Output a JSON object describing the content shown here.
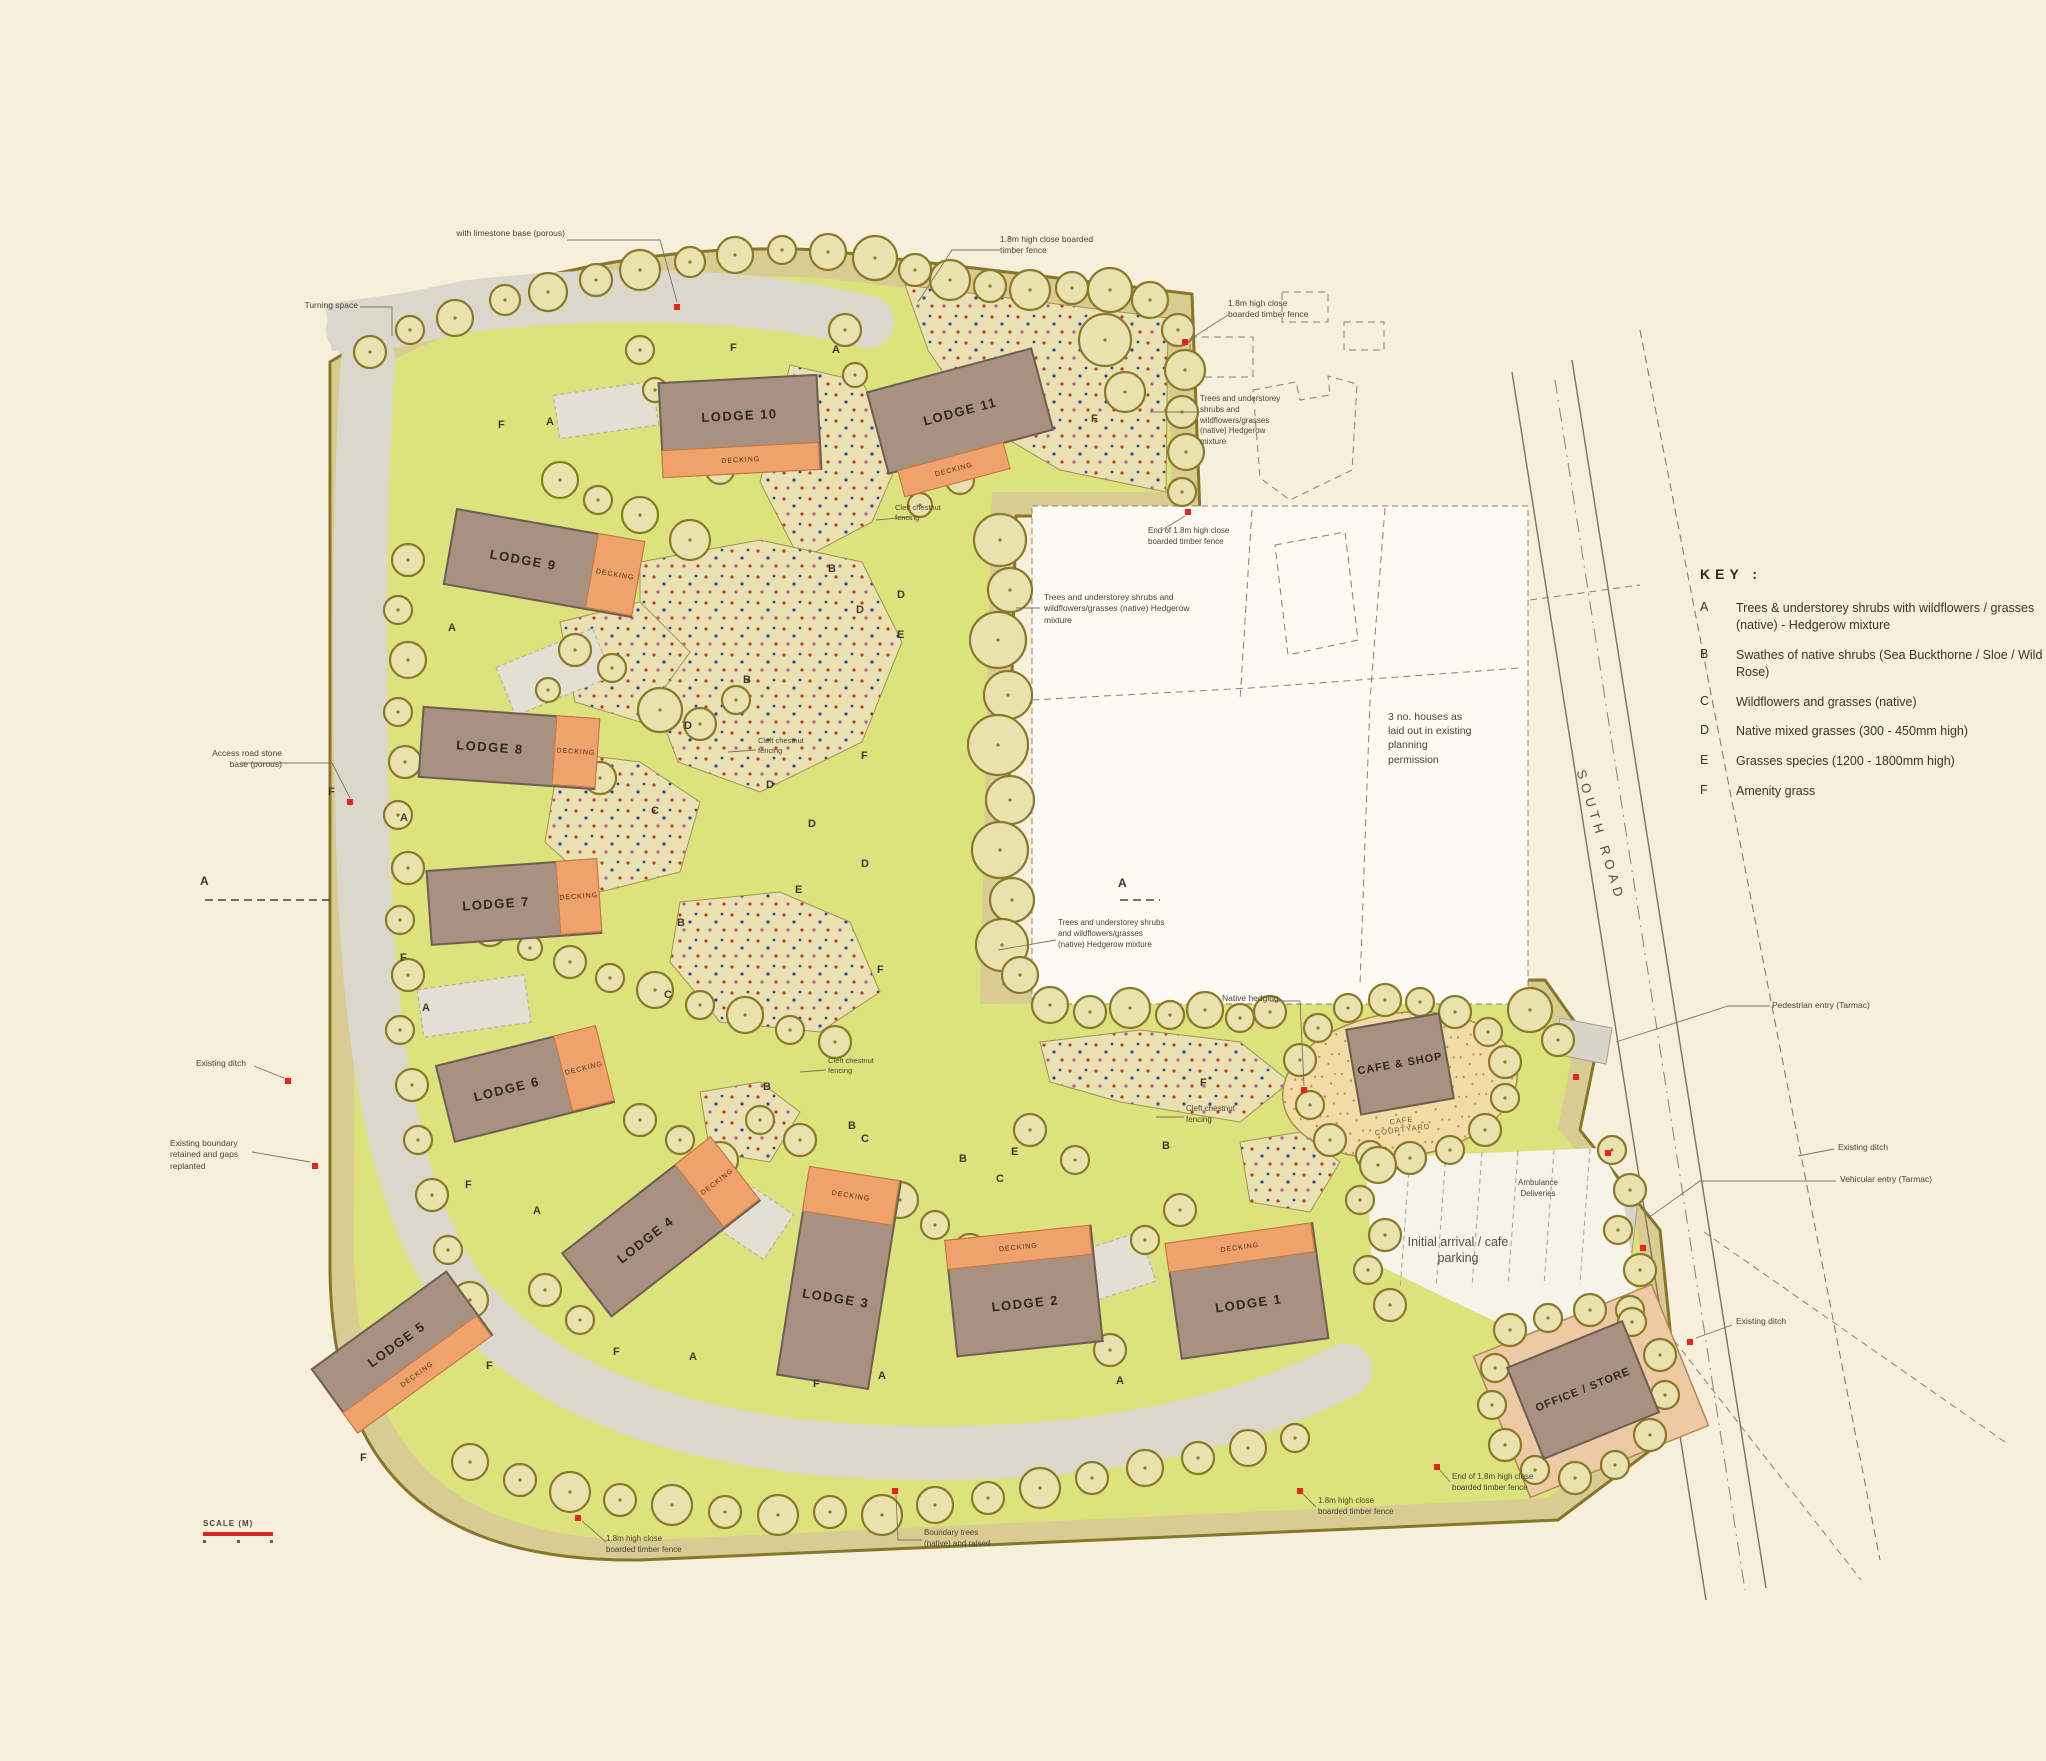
{
  "key": {
    "heading": "KEY :",
    "items": [
      {
        "code": "A",
        "label": "Trees & understorey shrubs with wildflowers / grasses (native) - Hedgerow mixture"
      },
      {
        "code": "B",
        "label": "Swathes of native shrubs (Sea Buckthorne / Sloe / Wild Rose)"
      },
      {
        "code": "C",
        "label": "Wildflowers and grasses (native)"
      },
      {
        "code": "D",
        "label": "Native mixed grasses (300 - 450mm high)"
      },
      {
        "code": "E",
        "label": "Grasses species (1200 - 1800mm high)"
      },
      {
        "code": "F",
        "label": "Amenity grass"
      }
    ]
  },
  "lodges": [
    {
      "name": "LODGE 1",
      "decking": "DECKING"
    },
    {
      "name": "LODGE 2",
      "decking": "DECKING"
    },
    {
      "name": "LODGE 3",
      "decking": "DECKING"
    },
    {
      "name": "LODGE 4",
      "decking": "DECKING"
    },
    {
      "name": "LODGE 5",
      "decking": "DECKING"
    },
    {
      "name": "LODGE 6",
      "decking": "DECKING"
    },
    {
      "name": "LODGE 7",
      "decking": "DECKING"
    },
    {
      "name": "LODGE 8",
      "decking": "DECKING"
    },
    {
      "name": "LODGE 9",
      "decking": "DECKING"
    },
    {
      "name": "LODGE 10",
      "decking": "DECKING"
    },
    {
      "name": "LODGE 11",
      "decking": "DECKING"
    }
  ],
  "buildings": {
    "cafe_shop": "CAFE & SHOP",
    "cafe_courtyard": "CAFE COURTYARD",
    "office_store": "OFFICE / STORE"
  },
  "roads": {
    "south_road": "SOUTH ROAD"
  },
  "zones": {
    "A": "A",
    "B": "B",
    "C": "C",
    "D": "D",
    "E": "E",
    "F": "F"
  },
  "notes": {
    "limestone": "with limestone base (porous)",
    "turning_space": "Turning space",
    "fence_18m": "1.8m high close boarded timber fence",
    "end_fence_18m": "End of 1.8m high close boarded timber fence",
    "hedgerow_mix": "Trees and understorey shrubs and wildflowers/grasses (native) Hedgerow mixture",
    "access_road": "Access road stone base (porous)",
    "existing_ditch": "Existing ditch",
    "boundary_retained": "Existing boundary retained and gaps replanted",
    "cleft_fencing": "Cleft chestnut fencing",
    "native_hedging": "Native hedging",
    "pedestrian_entry": "Pedestrian entry (Tarmac)",
    "vehicular_entry": "Vehicular entry (Tarmac)",
    "boundary_trees": "Boundary trees (native) and raised",
    "planning": "3 no. houses as laid out in existing planning permission",
    "ambulance": "Ambulance Deliveries",
    "arrival": "Initial arrival / cafe parking",
    "scale_label": "SCALE (M)",
    "section_marker": "A"
  }
}
